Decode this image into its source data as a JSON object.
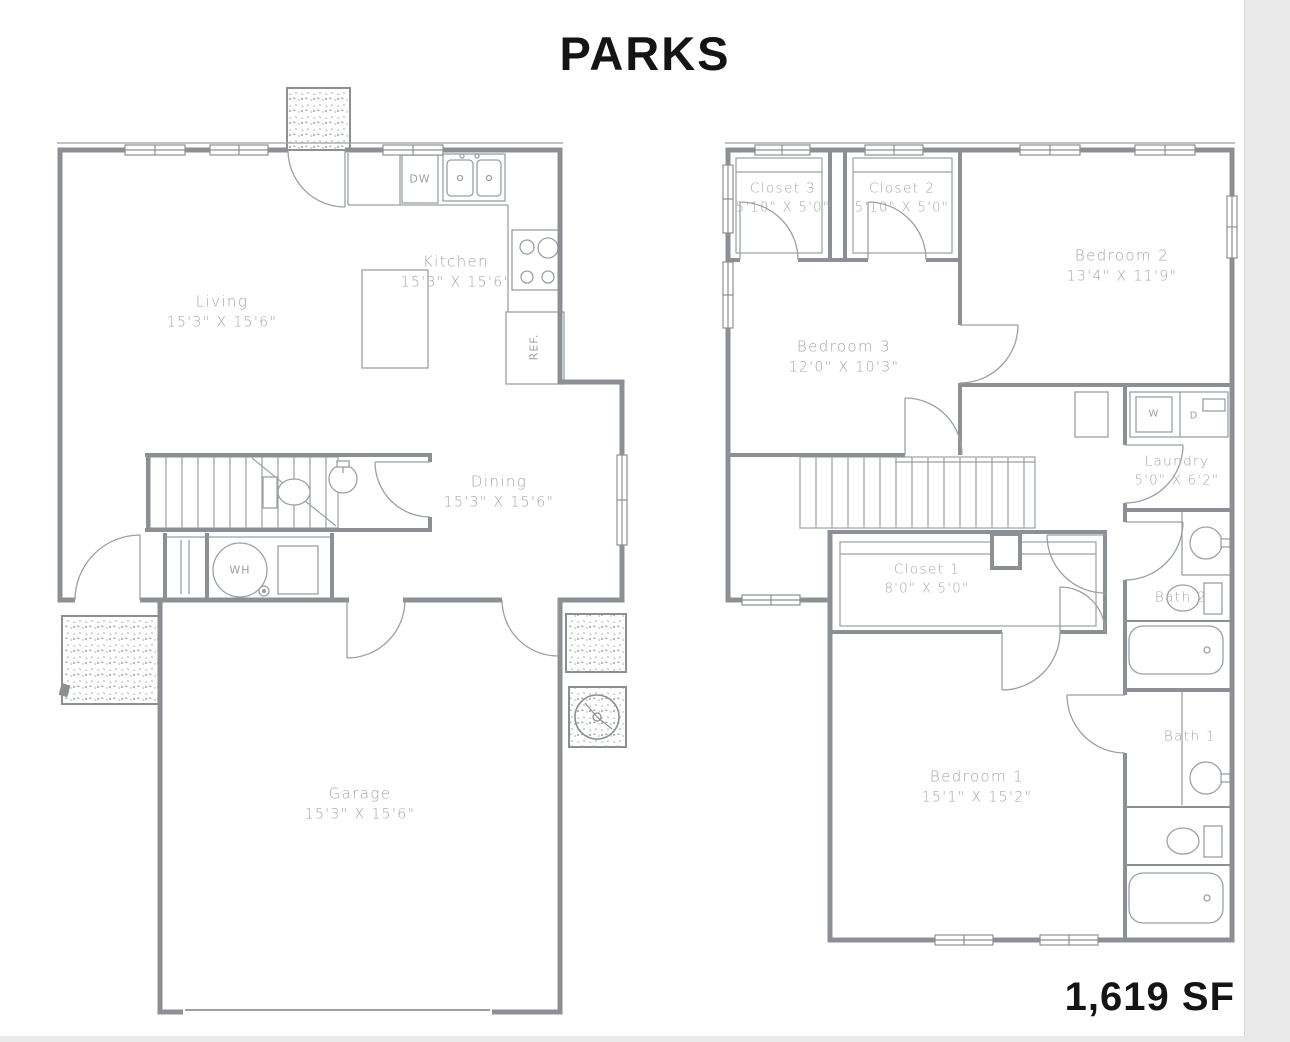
{
  "page": {
    "title": "PARKS",
    "total_area": "1,619 SF"
  },
  "floors": {
    "first": {
      "label": "first-floor",
      "rooms": [
        {
          "name": "Living",
          "dims": "15'3\" X 15'6\""
        },
        {
          "name": "Kitchen",
          "dims": "15'3\" X 15'6\""
        },
        {
          "name": "Dining",
          "dims": "15'3\" X 15'6\""
        },
        {
          "name": "Garage",
          "dims": "15'3\" X 15'6\""
        }
      ],
      "appliances": {
        "dishwasher": "DW",
        "refrigerator": "REF.",
        "water_heater": "WH"
      }
    },
    "second": {
      "label": "second-floor",
      "rooms": [
        {
          "name": "Closet 3",
          "dims": "5'10\" X 5'0\""
        },
        {
          "name": "Closet 2",
          "dims": "5'10\" X 5'0\""
        },
        {
          "name": "Bedroom 2",
          "dims": "13'4\" X 11'9\""
        },
        {
          "name": "Bedroom 3",
          "dims": "12'0\" X 10'3\""
        },
        {
          "name": "Laundry",
          "dims": "5'0\" X 6'2\""
        },
        {
          "name": "Closet 1",
          "dims": "8'0\" X 5'0\""
        },
        {
          "name": "Bath 2",
          "dims": ""
        },
        {
          "name": "Bath 1",
          "dims": ""
        },
        {
          "name": "Bedroom 1",
          "dims": "15'1\" X 15'2\""
        }
      ],
      "appliances": {
        "washer": "W",
        "dryer": "D"
      }
    }
  },
  "colors": {
    "wall": "#8c9094",
    "thin_line": "#9ba0a4",
    "label_text": "#a2a6aa",
    "title_text": "#141414",
    "page_edge": "#e9e9e9"
  }
}
